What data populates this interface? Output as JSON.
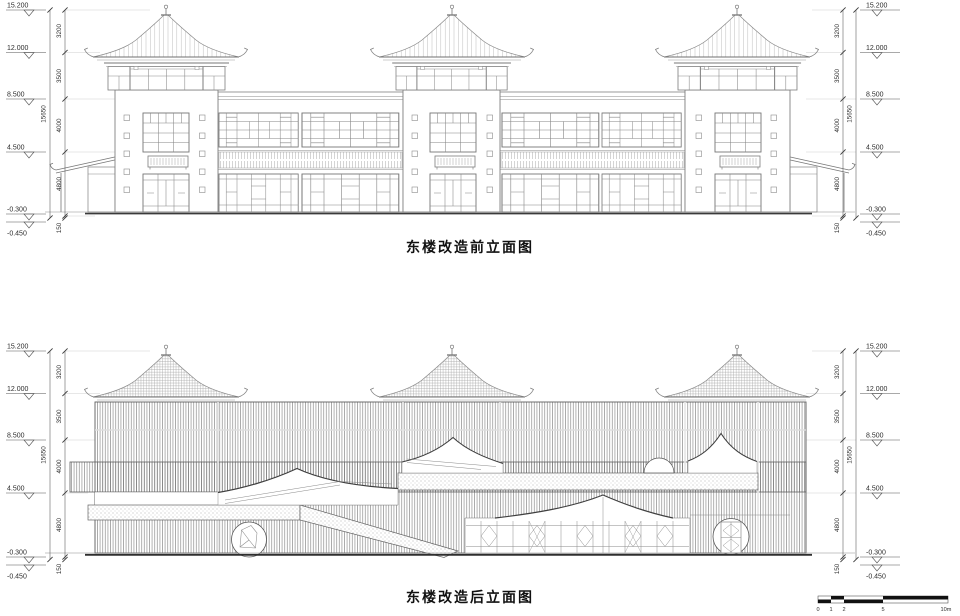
{
  "sheet": {
    "background": "#ffffff",
    "line_color": "#6e6e6e",
    "dark_line": "#333333"
  },
  "drawings": [
    {
      "title": "东楼改造前立面图",
      "levels": [
        "15.200",
        "12.000",
        "8.500",
        "4.500",
        "-0.300",
        "-0.450"
      ],
      "segments": [
        "3200",
        "3500",
        "4000",
        "4800",
        "150"
      ],
      "overall": "15650"
    },
    {
      "title": "东楼改造后立面图",
      "levels": [
        "15.200",
        "12.000",
        "8.500",
        "4.500",
        "-0.300",
        "-0.450"
      ],
      "segments": [
        "3200",
        "3500",
        "4000",
        "4800",
        "150"
      ],
      "overall": "15650"
    }
  ],
  "scale_bar": {
    "ticks": [
      "0",
      "1",
      "2",
      "5",
      "10m"
    ]
  }
}
